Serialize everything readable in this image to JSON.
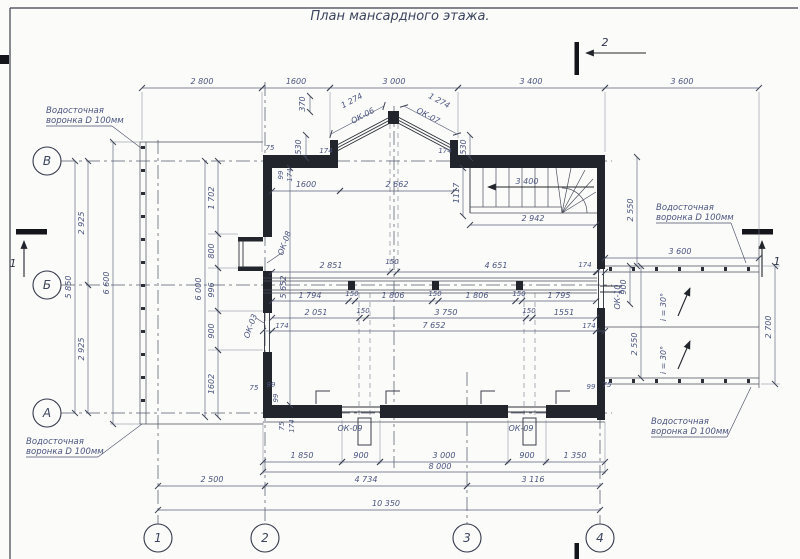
{
  "title": "План мансардного этажа.",
  "grid": {
    "rows": [
      "В",
      "Б",
      "А"
    ],
    "cols": [
      "1",
      "2",
      "3",
      "4"
    ]
  },
  "sections": {
    "one": "1",
    "two": "2"
  },
  "windows": {
    "ok03": "ОК-03",
    "ok06": "ОК-06",
    "ok07": "ОК-07",
    "ok08": "ОК-08",
    "ok09": "ОК-09",
    "ok10": "ОК-10"
  },
  "notes": {
    "funnel_line1": "Водосточная",
    "funnel_line2": "воронка D 100мм",
    "slope": "i = 30°"
  },
  "dims": {
    "top": [
      "2 800",
      "1600",
      "3 000",
      "3 400",
      "3 600"
    ],
    "bay": {
      "h370": "370",
      "h530l": "530",
      "h174l": "174",
      "slope_l": "1 274",
      "slope_r": "1 274",
      "h174r": "174",
      "h530r": "530"
    },
    "inner_top": {
      "d1600": "1600",
      "d2662": "2 662",
      "d1117": "1117",
      "d3400": "3 400",
      "d2942": "2 942"
    },
    "left": {
      "v2925a": "2 925",
      "v5850": "5 850",
      "v2925b": "2 925",
      "v6600": "6 600",
      "v6000": "6 000",
      "segs": [
        "1 702",
        "800",
        "996",
        "900",
        "1602"
      ],
      "v5652": "5 652"
    },
    "band1": [
      "2 851",
      "150",
      "4 651",
      "174"
    ],
    "band2": [
      "1 794",
      "150",
      "1 806",
      "150",
      "1 806",
      "150",
      "1 795"
    ],
    "band3": [
      "2 051",
      "150",
      "3 750",
      "150",
      "1551"
    ],
    "band4": {
      "left174": "174",
      "total": "7 652",
      "right174": "174"
    },
    "corners": {
      "tl": [
        "75",
        "99",
        "174"
      ],
      "bl": [
        "75",
        "99",
        "99",
        "75",
        "174"
      ],
      "br": [
        "99",
        "75"
      ]
    },
    "right": {
      "v2550t": "2 550",
      "h3600": "3 600",
      "v900": "900",
      "v2550b": "2 550",
      "v2700": "2 700"
    },
    "bottom": {
      "openings": [
        "1 850",
        "900",
        "3 000",
        "900",
        "1 350"
      ],
      "total8": "8 000",
      "grid": [
        "2 500",
        "4 734",
        "3 116"
      ],
      "total10": "10 350"
    }
  }
}
